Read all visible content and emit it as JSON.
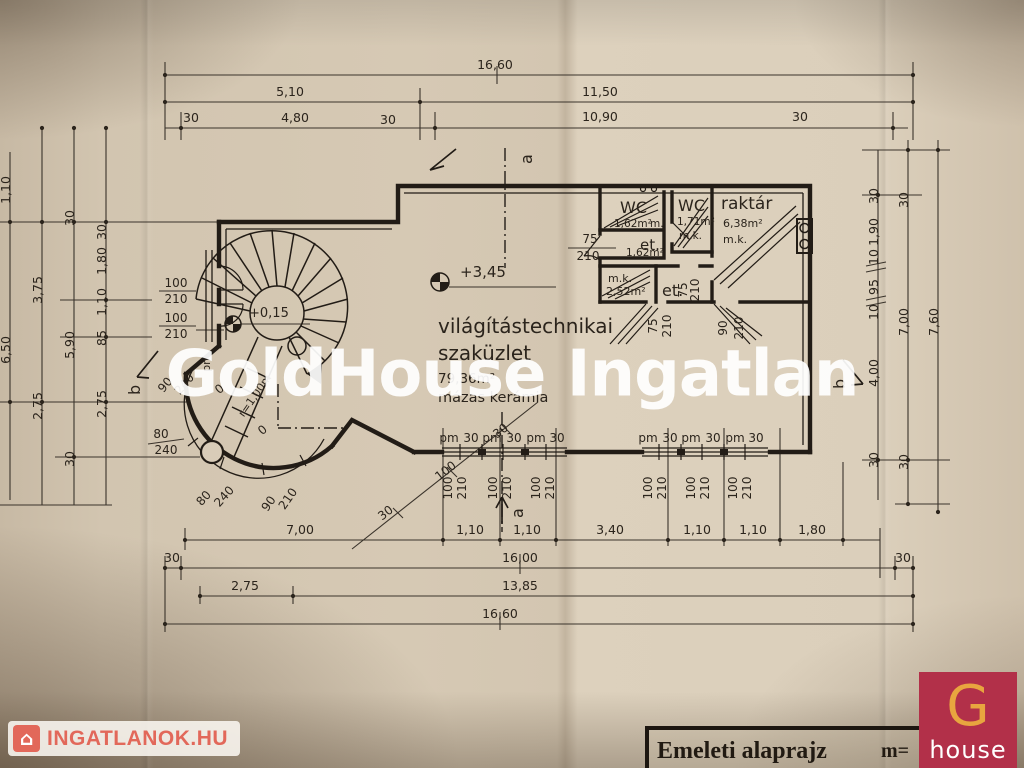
{
  "watermark": "GoldHouse Ingatlan",
  "branding": {
    "ingatlanok_logo": "INGATLANOK.HU",
    "ingatlanok_icon": "⌂",
    "ghouse_letter": "G",
    "ghouse_word": "house"
  },
  "title_block": {
    "title": "Emeleti alaprajz",
    "scale_label": "m="
  },
  "plan": {
    "rooms": {
      "shop": {
        "name1": "világítástechnikai",
        "name2": "szaküzlet",
        "area": "79,36m²",
        "floor": "mázas kerámia"
      },
      "wc1": {
        "name": "WC",
        "area": "1,62m²",
        "floor": "m."
      },
      "wc2": {
        "name": "WC",
        "area": "1,71m²",
        "floor": "m.k."
      },
      "raktar": {
        "name": "raktár",
        "area": "6,38m²",
        "floor": "m.k."
      },
      "et1": {
        "name": "et.",
        "area": "1,62m²"
      },
      "mk": {
        "name": "m.k.",
        "area": "2,52m²"
      },
      "et2": {
        "name": "et."
      }
    },
    "levels": {
      "upper": "+3,45",
      "entry": "+0,15"
    },
    "stair": {
      "radius": "r=1,00m"
    },
    "section_markers": {
      "a": "a",
      "b": "b"
    },
    "window_label": "pm",
    "zero": "0"
  },
  "dims": {
    "top": {
      "total": "16,60",
      "seg_a": "5,10",
      "seg_b": "11,50",
      "seg_c": "4,80",
      "seg_d": "10,90"
    },
    "bottom": {
      "row1": [
        "7,00",
        "1,10",
        "1,10",
        "3,40",
        "1,10",
        "1,10",
        "1,80"
      ],
      "row2_total": "16,00",
      "row3_a": "2,75",
      "row3_b": "13,85",
      "row4_total": "16,60"
    },
    "left": {
      "col1": [
        "1,10",
        "6,50"
      ],
      "col2": [
        "3,75",
        "2,75"
      ],
      "col3": [
        "30",
        "5,90",
        "30"
      ],
      "col4": [
        "30",
        "1,80",
        "1,10",
        "85",
        "2,75"
      ]
    },
    "right": {
      "col1": [
        "30",
        "1,90",
        "10",
        "95",
        "10",
        "4,00",
        "30"
      ],
      "col2": [
        "30",
        "7,00",
        "30"
      ],
      "col3": [
        "7,60"
      ]
    },
    "small": {
      "d30": "30",
      "d75": "75",
      "d80": "80",
      "d90": "90",
      "d100": "100",
      "d210": "210",
      "d240": "240"
    }
  }
}
